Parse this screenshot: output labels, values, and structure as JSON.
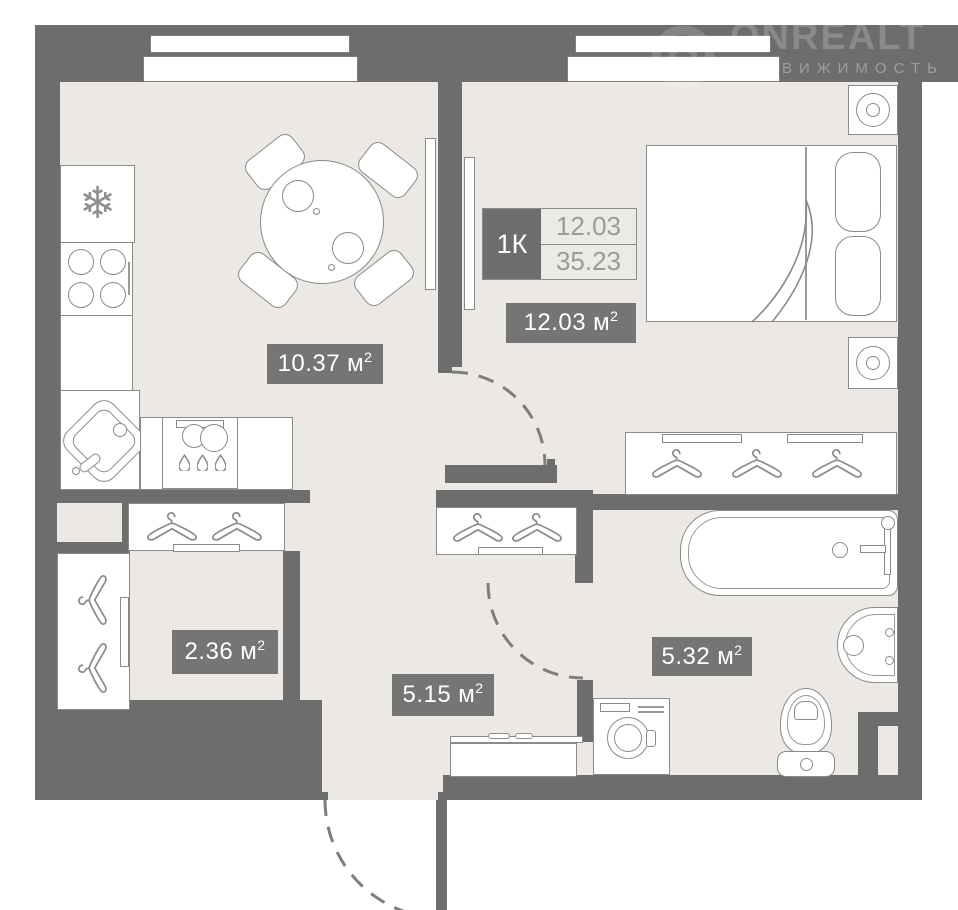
{
  "watermark": {
    "brand": "ONREALT",
    "tagline": "НЕДВИЖИМОСТЬ"
  },
  "info_table": {
    "apartment_type": "1К",
    "room_area": "12.03",
    "total_area": "35.23"
  },
  "rooms": {
    "kitchen_living": {
      "area_value": "10.37",
      "area_unit": "м",
      "area_sup": "2"
    },
    "bedroom": {
      "area_value": "12.03",
      "area_unit": "м",
      "area_sup": "2"
    },
    "wardrobe": {
      "area_value": "2.36",
      "area_unit": "м",
      "area_sup": "2"
    },
    "hallway": {
      "area_value": "5.15",
      "area_unit": "м",
      "area_sup": "2"
    },
    "bathroom": {
      "area_value": "5.32",
      "area_unit": "м",
      "area_sup": "2"
    }
  },
  "icons": {
    "snowflake": "❄"
  },
  "colors": {
    "wall": "#6d6d6d",
    "floor": "#ece8e3",
    "furniture_outline": "#8a8a8a",
    "badge_bg": "#757575",
    "badge_text": "#ffffff",
    "table_value_text": "#9b9b9b"
  }
}
